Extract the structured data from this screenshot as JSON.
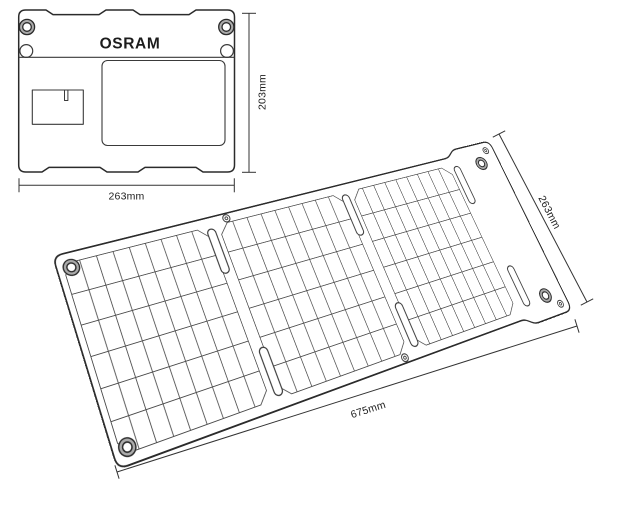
{
  "drawing": {
    "brand": "OSRAM",
    "folded_view": {
      "width_label": "263mm",
      "height_label": "203mm"
    },
    "unfolded_view": {
      "length_label": "675mm",
      "height_label": "263mm",
      "sections": 3,
      "grid_columns_per_section": 9,
      "grid_rows_per_section": 6
    }
  },
  "colors": {
    "outline": "#2b2b2b",
    "inner_line": "#3a3a3a",
    "grid_line": "#4a4a4a",
    "dim_line": "#333333",
    "grommet_ring": "#ababab",
    "background": "#ffffff"
  }
}
